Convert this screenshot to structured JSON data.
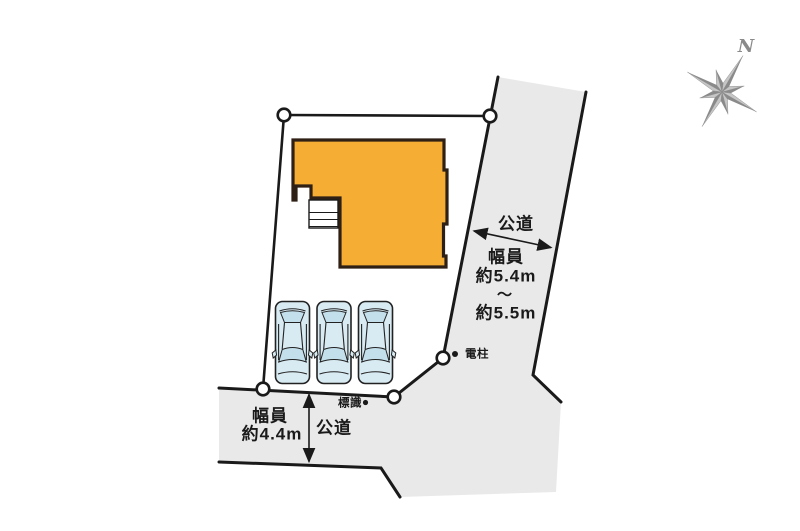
{
  "compass": {
    "north_label": "N"
  },
  "roads": {
    "right": {
      "name": "公道",
      "width_label": "幅員",
      "width_min": "約5.4m",
      "range_separator": "～",
      "width_max": "約5.5m"
    },
    "bottom": {
      "name": "公道",
      "width_label": "幅員",
      "width_value": "約4.4m"
    }
  },
  "markers": {
    "utility_pole_label": "電柱",
    "sign_label": "標識"
  },
  "parking": {
    "car_count": 3
  },
  "colors": {
    "building": "#F5AE33",
    "buildingOutline": "#2E2014",
    "road": "#E9E9E9",
    "line": "#1A1A1A",
    "carBody": "#D8EAF2",
    "carWindow": "#C3DFEB",
    "compass": "#8A8A8A",
    "compassLight": "#C6C6C6"
  }
}
